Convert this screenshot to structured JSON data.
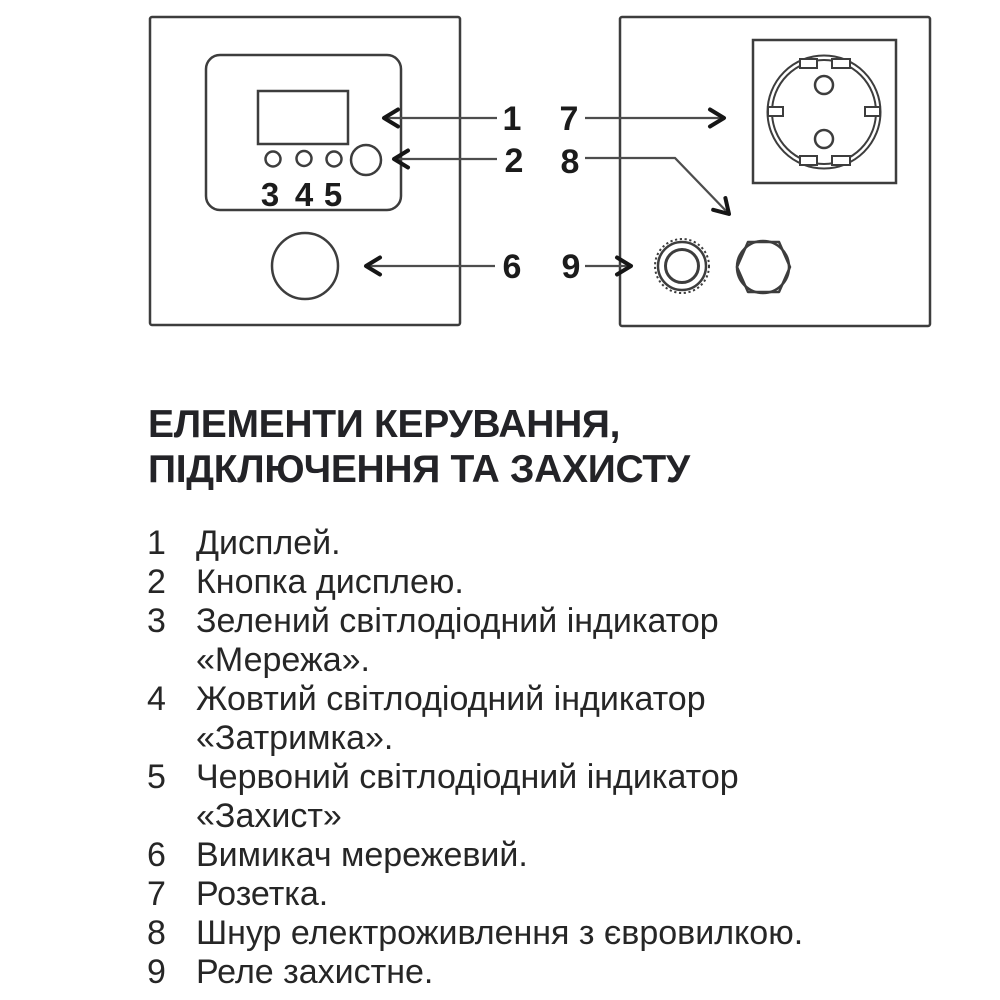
{
  "heading": {
    "line1": "ЕЛЕМЕНТИ КЕРУВАННЯ,",
    "line2": "ПІДКЛЮЧЕННЯ ТА ЗАХИСТУ"
  },
  "diagram": {
    "front_panel": {
      "led_labels": [
        "3",
        "4",
        "5"
      ],
      "callouts": [
        "1",
        "2",
        "6"
      ]
    },
    "rear_panel": {
      "callouts": [
        "7",
        "8",
        "9"
      ]
    }
  },
  "legend": {
    "items": [
      {
        "num": "1",
        "lines": [
          "Дисплей."
        ]
      },
      {
        "num": "2",
        "lines": [
          "Кнопка дисплею."
        ]
      },
      {
        "num": "3",
        "lines": [
          "Зелений світлодіодний індикатор",
          "«Мережа»."
        ]
      },
      {
        "num": "4",
        "lines": [
          "Жовтий світлодіодний індикатор",
          "«Затримка»."
        ]
      },
      {
        "num": "5",
        "lines": [
          "Червоний світлодіодний індикатор",
          "«Захист»"
        ]
      },
      {
        "num": "6",
        "lines": [
          "Вимикач мережевий."
        ]
      },
      {
        "num": "7",
        "lines": [
          "Розетка."
        ]
      },
      {
        "num": "8",
        "lines": [
          "Шнур електроживлення з євровилкою."
        ]
      },
      {
        "num": "9",
        "lines": [
          "Реле захистне."
        ]
      }
    ]
  },
  "colors": {
    "background": "#ffffff",
    "ink": "#232327",
    "outline": "#3d3d3d",
    "arrow": "#4d4d4d"
  }
}
